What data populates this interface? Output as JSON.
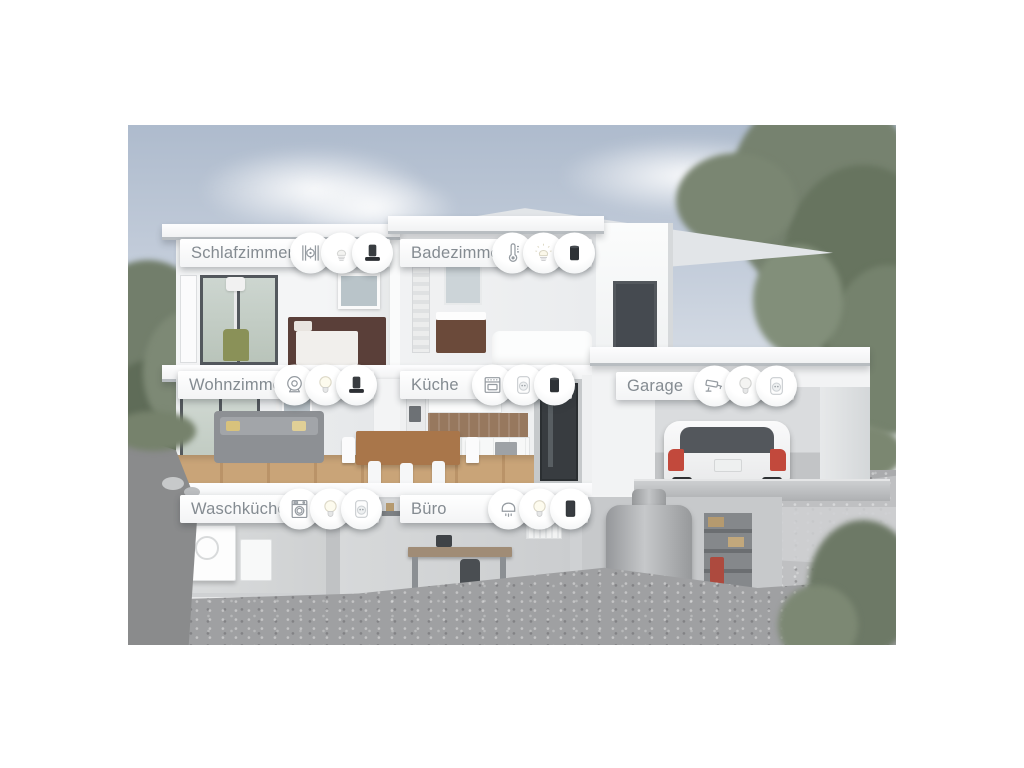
{
  "scene_title": "Smart home cutaway floor diagram",
  "rooms": [
    {
      "label": "Schlafzimmer",
      "devices": [
        "radiator-thermostat",
        "spot-bulb",
        "smart-speaker"
      ]
    },
    {
      "label": "Badezimmer",
      "devices": [
        "thermometer",
        "spot-bulb",
        "smart-speaker-cylinder"
      ]
    },
    {
      "label": "Wohnzimmer",
      "devices": [
        "indoor-camera",
        "light-bulb",
        "smart-speaker"
      ]
    },
    {
      "label": "Küche",
      "devices": [
        "oven",
        "smart-plug",
        "smart-speaker-cylinder"
      ]
    },
    {
      "label": "Garage",
      "devices": [
        "security-camera",
        "light-bulb",
        "smart-plug"
      ]
    },
    {
      "label": "Waschküche",
      "devices": [
        "washing-machine",
        "light-bulb",
        "smart-plug"
      ]
    },
    {
      "label": "Büro",
      "devices": [
        "ceiling-lamp",
        "light-bulb",
        "smart-speaker"
      ]
    }
  ],
  "colors": {
    "label_text": "#848b91",
    "pill_background": "#ffffff",
    "icon_stroke": "#959ba1",
    "sky_top": "#aebbcd",
    "sky_bottom": "#e8eaec",
    "wall_white": "#f4f5f6",
    "car_accent_red": "#c2493c",
    "foliage_green": "#73806b",
    "gravel_gray": "#a2a3a5",
    "wood_floor": "#c8a376",
    "device_dark": "#33373b"
  }
}
